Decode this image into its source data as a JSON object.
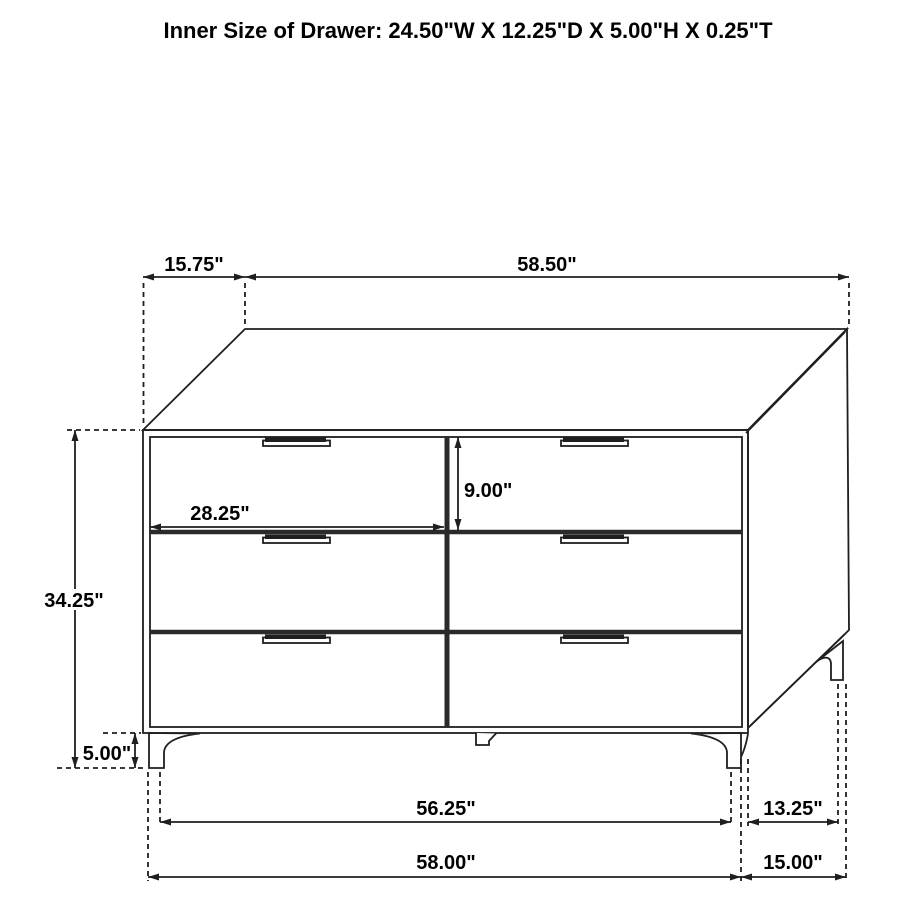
{
  "title": "Inner Size of Drawer: 24.50\"W X 12.25\"D X 5.00\"H X 0.25\"T",
  "dims": {
    "top_depth": "15.75\"",
    "top_width": "58.50\"",
    "case_height": "34.25\"",
    "leg_height": "5.00\"",
    "drawer_front_width": "28.25\"",
    "drawer_front_height": "9.00\"",
    "front_legs_inner_span": "56.25\"",
    "side_legs_span": "13.25\"",
    "overall_width": "58.00\"",
    "overall_depth": "15.00\""
  },
  "colors": {
    "line": "#1f1f1f",
    "text": "#000000",
    "background": "#ffffff"
  }
}
